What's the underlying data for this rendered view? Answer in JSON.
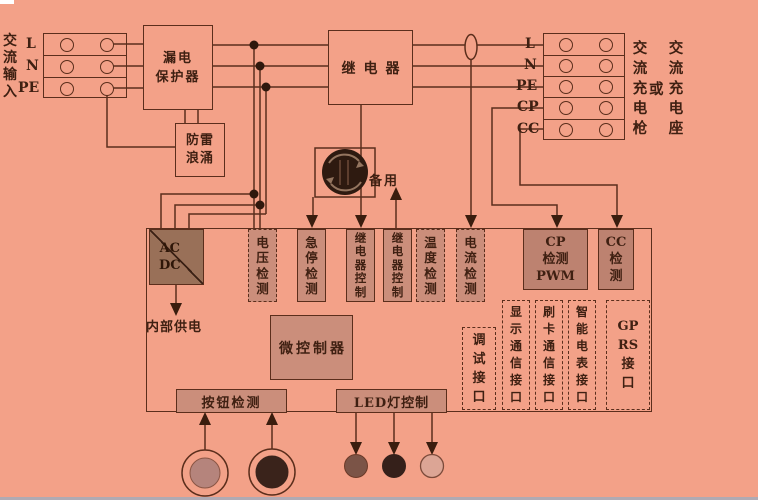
{
  "colors": {
    "background": "#f3a188",
    "line": "#5b2e1c",
    "text": "#3f2012",
    "box_fill": "#cb8e7b",
    "cp_cc_fill": "#bd8270",
    "acdc_fill": "#997058",
    "junction_dot": "#2f180d",
    "estop_button": "#2e1a10",
    "button1_inner": "#b5847c",
    "button2_inner": "#3a231b",
    "led1": "#7b5447",
    "led2": "#35201a",
    "led3": "#dca595",
    "bottom_strip": "#93aec6"
  },
  "left": {
    "ac_input": "交\n流\n输\n入",
    "rows": [
      "L",
      "N",
      "PE"
    ]
  },
  "top": {
    "leakage_protector": "漏电\n保护器",
    "surge_protector": "防雷\n浪涌",
    "relay": "继电器",
    "spare": "备用"
  },
  "right": {
    "rows": [
      "L",
      "N",
      "PE",
      "CP",
      "CC"
    ],
    "gun": "交\n流\n充\n电\n枪",
    "or": "或",
    "socket": "交\n流\n充\n电\n座"
  },
  "board": {
    "acdc": "AC\nDC",
    "internal_power": "内部供电",
    "voltage_detect": "电\n压\n检\n测",
    "estop_detect": "急\n停\n检\n测",
    "relay_control_1": "继\n电\n器\n控\n制",
    "relay_control_2": "继\n电\n器\n控\n制",
    "temp_detect": "温\n度\n检\n测",
    "current_detect": "电\n流\n检\n测",
    "cp_detect": "CP\n检测\nPWM",
    "cc_detect": "CC\n检\n测",
    "mcu": "微控制器",
    "debug_port": "调\n试\n接\n口",
    "display_port": "显\n示\n通\n信\n接\n口",
    "card_port": "刷\n卡\n通\n信\n接\n口",
    "meter_port": "智\n能\n电\n表\n接\n口",
    "gprs_port": "GP\nRS\n接\n口",
    "button_detect": "按钮检测",
    "led_control": "LED灯控制"
  }
}
